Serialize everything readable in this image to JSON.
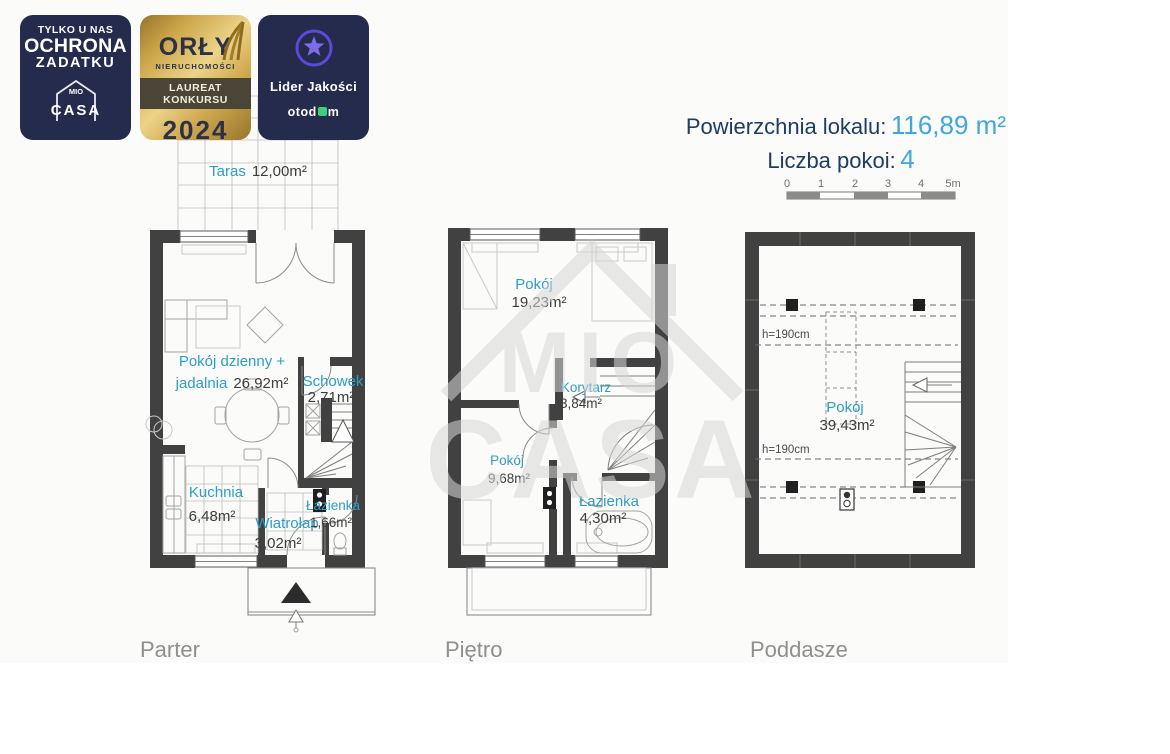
{
  "badges": {
    "ochrona": {
      "line1": "TYLKO U NAS",
      "line2": "OCHRONA",
      "line3": "ZADATKU",
      "logo_mio": "MIO",
      "logo_casa": "CASA"
    },
    "orly": {
      "title": "ORŁY",
      "subtitle": "NIERUCHOMOŚCI",
      "banner": "LAUREAT KONKURSU",
      "year": "2024"
    },
    "lider": {
      "title": "Lider Jakości",
      "brand_pre": "otod",
      "brand_post": "m"
    }
  },
  "header": {
    "area_label": "Powierzchnia lokalu:",
    "area_value": "116,89 m²",
    "rooms_label": "Liczba pokoi:",
    "rooms_value": "4"
  },
  "scale_bar": {
    "ticks": [
      "0",
      "1",
      "2",
      "3",
      "4",
      "5m"
    ]
  },
  "watermark": {
    "mio": "MIO",
    "casa": "CASA"
  },
  "floors": {
    "parter": {
      "label": "Parter",
      "taras_name": "Taras",
      "taras_area": "12,00m²",
      "living_line1": "Pokój dzienny +",
      "living_name2": "jadalnia",
      "living_area": "26,92m²",
      "schowek_name": "Schowek",
      "schowek_area": "2,71m²",
      "kuchnia_name": "Kuchnia",
      "kuchnia_area": "6,48m²",
      "wiatrolap_name": "Wiatrołap",
      "wiatrolap_area": "3,02m²",
      "lazienka_name": "Łazienka",
      "lazienka_area": "1,66m²"
    },
    "pietro": {
      "label": "Piętro",
      "pokoj1_name": "Pokój",
      "pokoj1_area": "19,23m²",
      "korytarz_name": "Korytarz",
      "korytarz_area": "3,84m²",
      "pokoj2_name": "Pokój",
      "pokoj2_area": "9,68m²",
      "lazienka_name": "Łazienka",
      "lazienka_area": "4,30m²"
    },
    "poddasze": {
      "label": "Poddasze",
      "pokoj_name": "Pokój",
      "pokoj_area": "39,43m²",
      "height_note_upper": "h=190cm",
      "height_note_lower": "h=190cm"
    }
  },
  "colors": {
    "accent_blue": "#2d9dc8",
    "navy": "#1c3d63",
    "value_blue": "#3fa7e0",
    "wall": "#414141",
    "otodom_green": "#3bd07a"
  }
}
